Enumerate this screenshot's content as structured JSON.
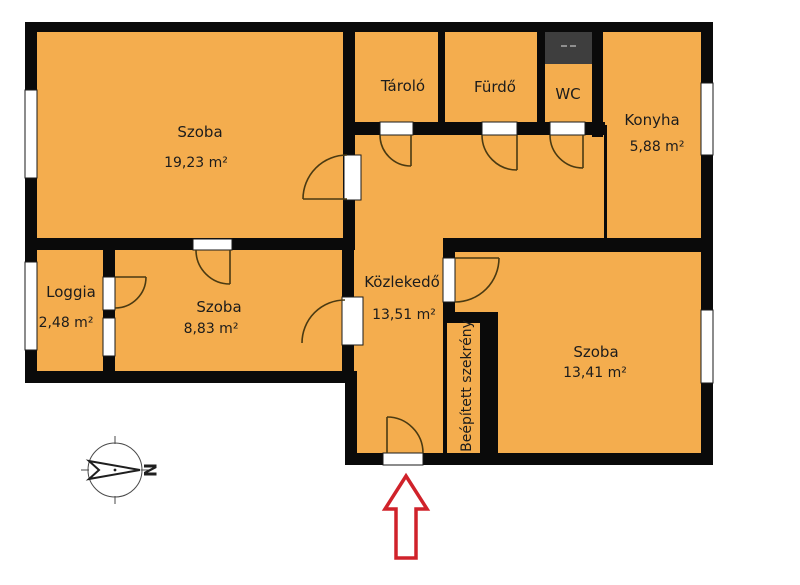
{
  "palette": {
    "room_fill": "#F4AD4E",
    "wall": "#0A0A0A",
    "shaft": "#3E3E3E",
    "shaft_mark": "#8F8F8F",
    "door_arc": "#4A3A12",
    "arrow_red": "#D0222A",
    "text": "#1C1C1C"
  },
  "rooms": {
    "szoba_large": {
      "name": "Szoba",
      "area": "19,23 m²"
    },
    "tarolo": {
      "name": "Tároló"
    },
    "furdo": {
      "name": "Fürdő"
    },
    "wc": {
      "name": "WC"
    },
    "konyha": {
      "name": "Konyha",
      "area": "5,88 m²"
    },
    "loggia": {
      "name": "Loggia",
      "area": "2,48 m²"
    },
    "szoba_small": {
      "name": "Szoba",
      "area": "8,83 m²"
    },
    "kozlekedo": {
      "name": "Közlekedő",
      "area": "13,51 m²"
    },
    "szoba_right": {
      "name": "Szoba",
      "area": "13,41 m²"
    },
    "szekreny": {
      "name": "Beépített szekrény"
    }
  },
  "compass": {
    "north_label": "N"
  }
}
